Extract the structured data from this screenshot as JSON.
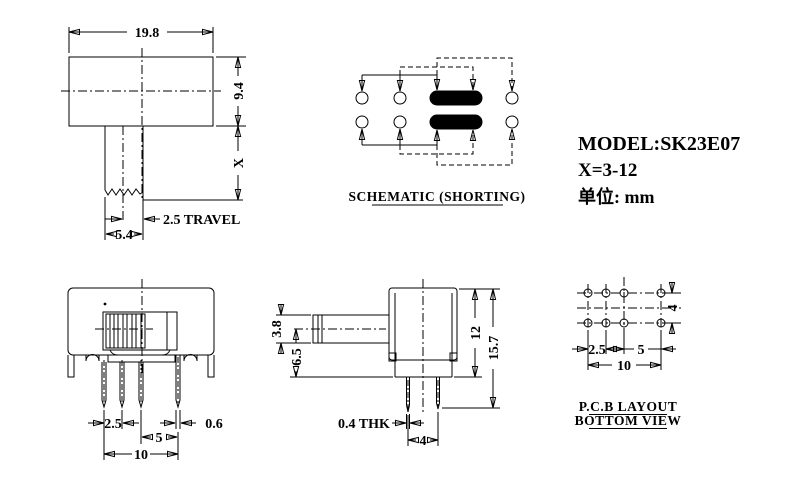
{
  "title_block": {
    "model": "MODEL:SK23E07",
    "x_range": "X=3-12",
    "unit": "单位: mm"
  },
  "front_view": {
    "dims": {
      "body_width": "19.8",
      "body_height": "9.4",
      "stem_length": "X",
      "travel": "2.5 TRAVEL",
      "stem_width": "5.4"
    }
  },
  "schematic": {
    "label": "SCHEMATIC (SHORTING)"
  },
  "pin_view": {
    "dims": {
      "pitch_small": "2.5",
      "pitch_large": "5",
      "overall": "10",
      "pin_width": "0.6"
    }
  },
  "side_view": {
    "dims": {
      "knob_height": "3.8",
      "center_to_base": "6.5",
      "body_height": "12",
      "total_height": "15.7",
      "pin_thickness": "0.4 THK",
      "pin_spacing": "4"
    }
  },
  "pcb_layout": {
    "label_line1": "P.C.B LAYOUT",
    "label_line2": "BOTTOM VIEW",
    "dims": {
      "pitch_small": "2.5",
      "pitch_large": "5",
      "overall": "10",
      "row_spacing": "4"
    }
  }
}
